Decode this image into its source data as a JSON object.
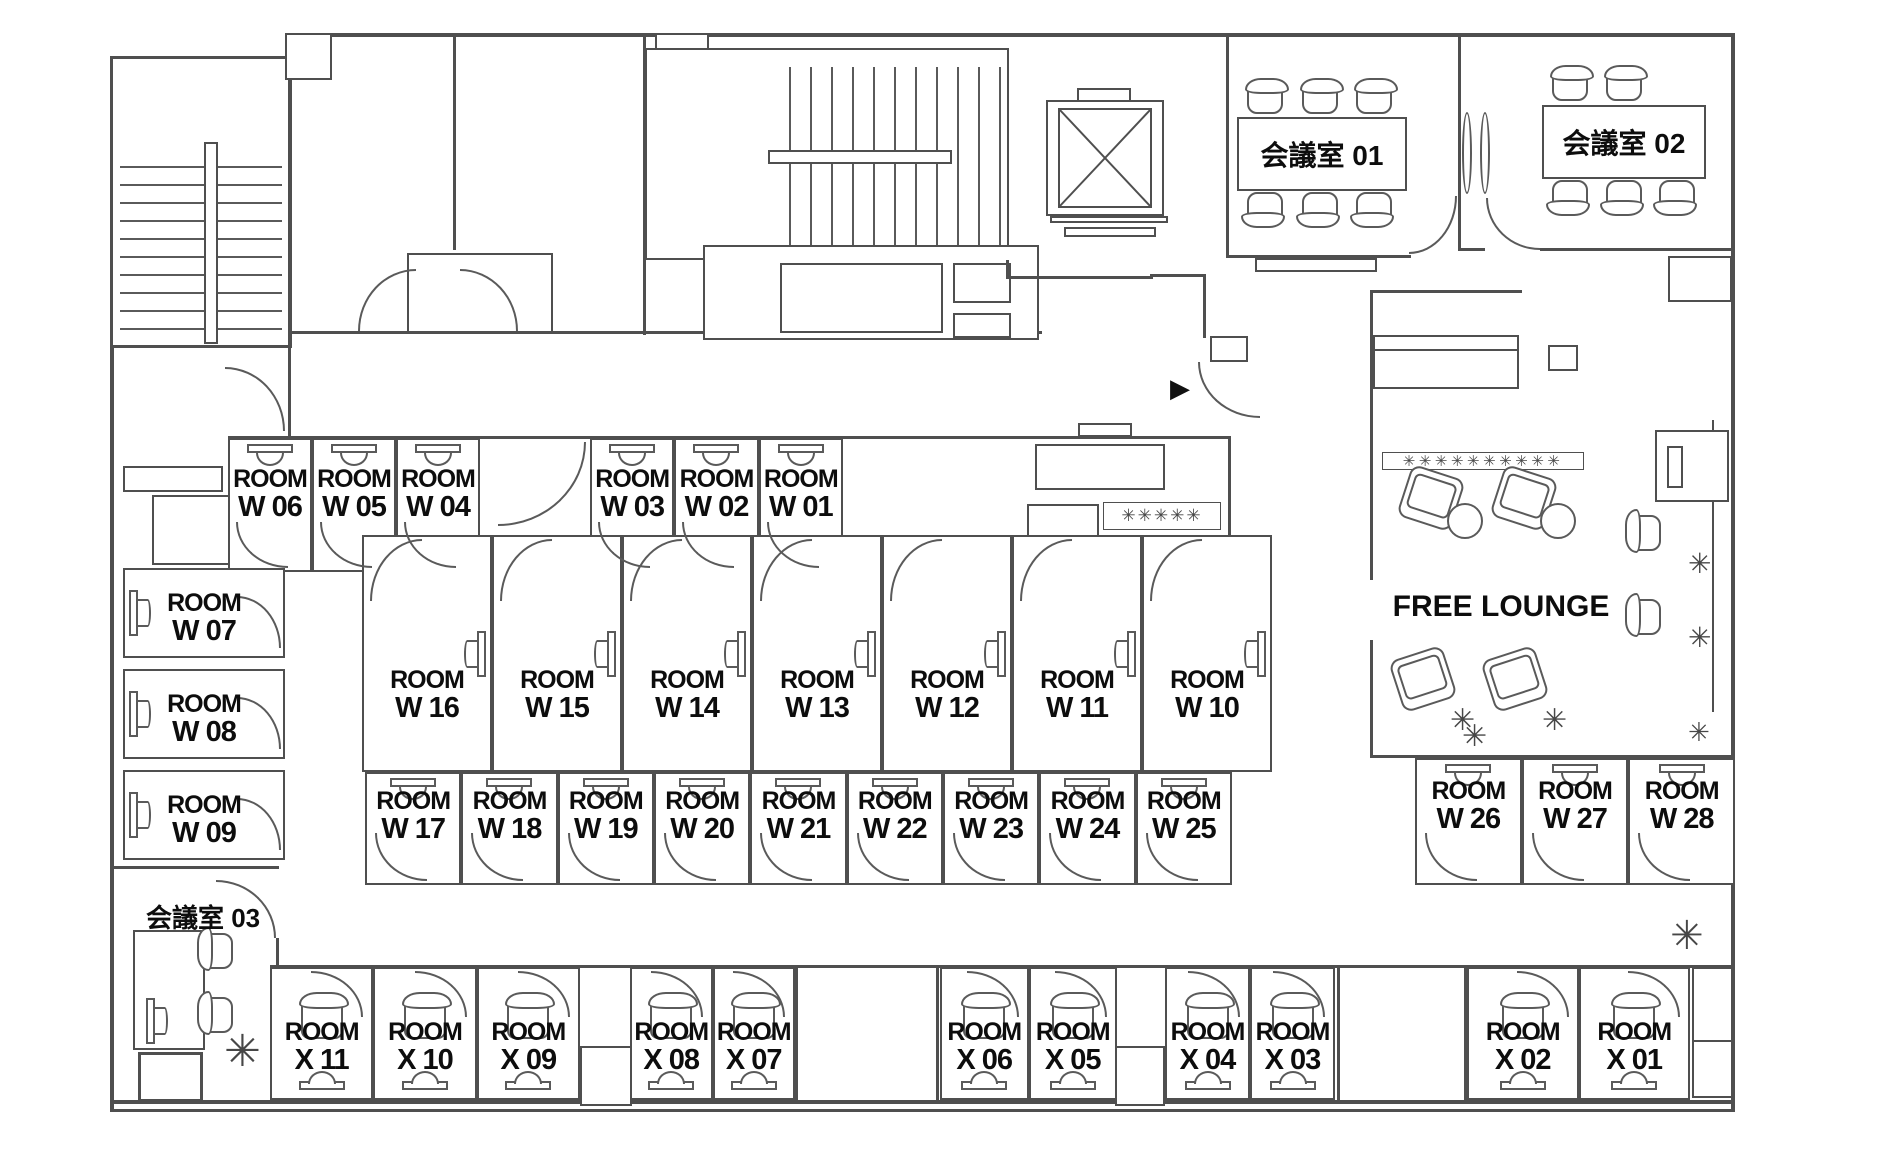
{
  "room_prefix": "ROOM",
  "rows": {
    "top_a": [
      "W 06",
      "W 05",
      "W 04"
    ],
    "top_b": [
      "W 03",
      "W 02",
      "W 01"
    ],
    "left_col": [
      "W 07",
      "W 08",
      "W 09"
    ],
    "mid_row1": [
      "W 16",
      "W 15",
      "W 14",
      "W 13",
      "W 12",
      "W 11",
      "W 10"
    ],
    "mid_row2": [
      "W 17",
      "W 18",
      "W 19",
      "W 20",
      "W 21",
      "W 22",
      "W 23",
      "W 24",
      "W 25"
    ],
    "right_row": [
      "W 26",
      "W 27",
      "W 28"
    ],
    "bottom_a": [
      "X 11",
      "X 10",
      "X 09"
    ],
    "bottom_b": [
      "X 08",
      "X 07"
    ],
    "bottom_c": [
      "X 06",
      "X 05"
    ],
    "bottom_d": [
      "X 04",
      "X 03"
    ],
    "bottom_e": [
      "X 02",
      "X 01"
    ]
  },
  "meeting_rooms": {
    "m01": "会議室 01",
    "m02": "会議室 02",
    "m03": "会議室 03"
  },
  "lounge": {
    "label": "FREE LOUNGE"
  },
  "icons": {
    "plant": "✳",
    "hedge_row": "✳✳✳✳✳✳✳✳✳✳",
    "pantry_row": "✳✳✳✳✳",
    "entrance_arrow": "▶"
  },
  "colors": {
    "wall": "#4f4f4f",
    "furniture": "#5a5a5a",
    "text": "#111111"
  }
}
